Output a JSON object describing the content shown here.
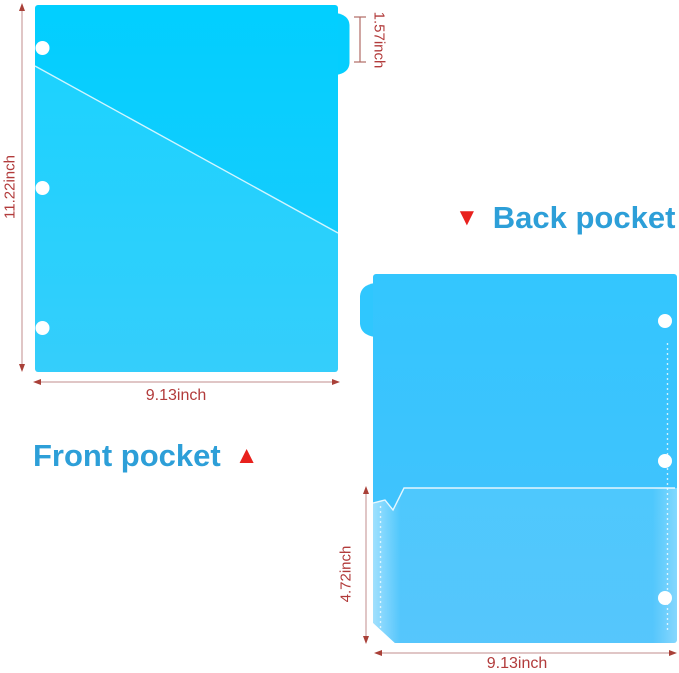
{
  "front_view": {
    "caption": "Front pocket",
    "caption_marker": "▲",
    "height_label": "11.22inch",
    "tab_label": "1.57inch",
    "width_label": "9.13inch"
  },
  "back_view": {
    "caption": "Back pocket",
    "caption_marker": "▼",
    "pocket_height_label": "4.72inch",
    "width_label": "9.13inch"
  },
  "colors": {
    "front_folder_cyan": "#04cefe",
    "back_folder_cyan": "#3ac5fe",
    "caption_blue": "#2d9fd8",
    "marker_red": "#e8211d",
    "dimension_red": "#b23b3b"
  }
}
